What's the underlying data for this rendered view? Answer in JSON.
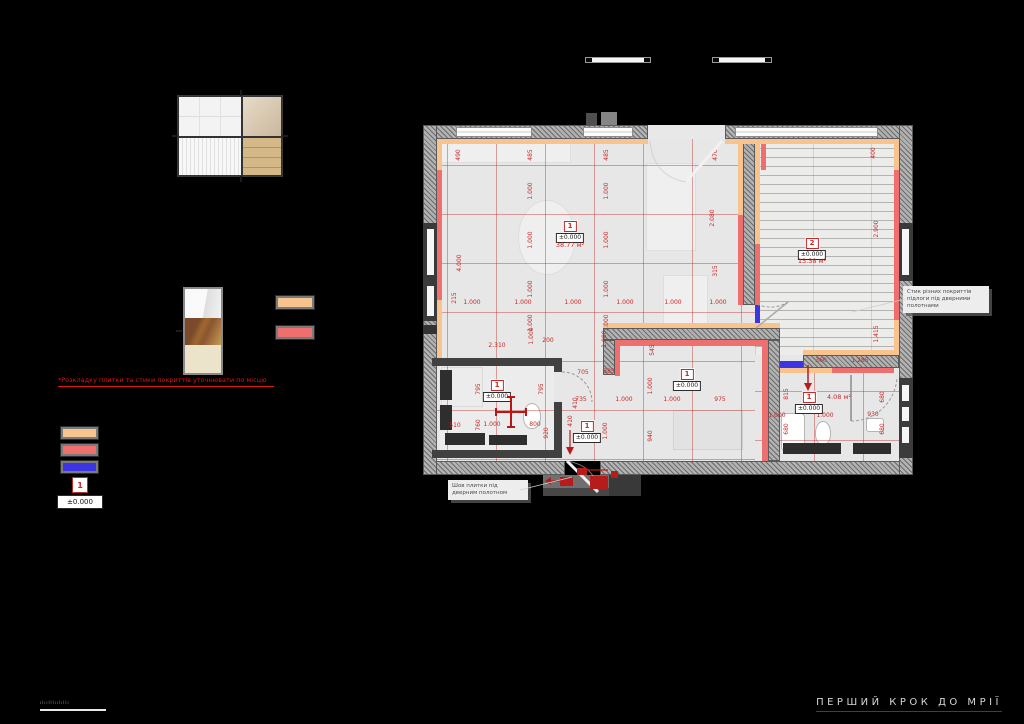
{
  "page": {
    "bg": "#000000"
  },
  "colors": {
    "accent_orange": "#F7C490",
    "accent_red": "#EF6E6E",
    "accent_blue": "#3D35E3",
    "dim_red": "#C62828"
  },
  "legend": {
    "note": "*Розкладку плитки та стики покриттів уточнювати по місцю",
    "room_index_label": "1"
  },
  "callouts": {
    "junction": "Стик різних покриттів\nпідлоги під дверними\nполотнами",
    "tile_seam": "Шов плитки під\nдверним полотном"
  },
  "plan": {
    "elevation": "±0.000",
    "rooms": [
      {
        "num": "1",
        "x": 147,
        "y": 96
      },
      {
        "num": "2",
        "x": 389,
        "y": 113
      },
      {
        "num": "1",
        "x": 74,
        "y": 255
      },
      {
        "num": "1",
        "x": 264,
        "y": 244
      },
      {
        "num": "1",
        "x": 164,
        "y": 296
      },
      {
        "num": "1",
        "x": 386,
        "y": 267
      }
    ],
    "area_labels": [
      {
        "t": "38.77 м²",
        "x": 147,
        "y": 120
      },
      {
        "t": "13.38 м²",
        "x": 389,
        "y": 136
      },
      {
        "t": "4.08 м²",
        "x": 416,
        "y": 272
      }
    ],
    "dim_labels": [
      {
        "t": "490",
        "x": 36,
        "y": 30,
        "v": 1
      },
      {
        "t": "485",
        "x": 108,
        "y": 30,
        "v": 1
      },
      {
        "t": "485",
        "x": 184,
        "y": 30,
        "v": 1
      },
      {
        "t": "470",
        "x": 293,
        "y": 30,
        "v": 1
      },
      {
        "t": "400",
        "x": 451,
        "y": 28,
        "v": 1
      },
      {
        "t": "1.000",
        "x": 108,
        "y": 66,
        "v": 1
      },
      {
        "t": "1.000",
        "x": 108,
        "y": 115,
        "v": 1
      },
      {
        "t": "1.000",
        "x": 108,
        "y": 164,
        "v": 1
      },
      {
        "t": "1.000",
        "x": 108,
        "y": 198,
        "v": 1
      },
      {
        "t": "1.000",
        "x": 184,
        "y": 66,
        "v": 1
      },
      {
        "t": "1.000",
        "x": 184,
        "y": 115,
        "v": 1
      },
      {
        "t": "1.000",
        "x": 184,
        "y": 164,
        "v": 1
      },
      {
        "t": "1.000",
        "x": 184,
        "y": 198,
        "v": 1
      },
      {
        "t": "2.080",
        "x": 290,
        "y": 93,
        "v": 1
      },
      {
        "t": "315",
        "x": 293,
        "y": 146,
        "v": 1
      },
      {
        "t": "2.900",
        "x": 454,
        "y": 104,
        "v": 1
      },
      {
        "t": "4.000",
        "x": 37,
        "y": 138,
        "v": 1
      },
      {
        "t": "215",
        "x": 32,
        "y": 173,
        "v": 1
      },
      {
        "t": "1.415",
        "x": 454,
        "y": 209,
        "v": 1
      },
      {
        "t": "545",
        "x": 230,
        "y": 225,
        "v": 1
      },
      {
        "t": "1.000",
        "x": 228,
        "y": 261,
        "v": 1
      },
      {
        "t": "940",
        "x": 228,
        "y": 311,
        "v": 1
      },
      {
        "t": "1.000",
        "x": 183,
        "y": 306,
        "v": 1
      },
      {
        "t": "1.000",
        "x": 109,
        "y": 211,
        "v": 1
      },
      {
        "t": "1.000",
        "x": 182,
        "y": 214,
        "v": 1
      },
      {
        "t": "795",
        "x": 56,
        "y": 264,
        "v": 1
      },
      {
        "t": "795",
        "x": 119,
        "y": 264,
        "v": 1
      },
      {
        "t": "760",
        "x": 56,
        "y": 300,
        "v": 1
      },
      {
        "t": "920",
        "x": 124,
        "y": 308,
        "v": 1
      },
      {
        "t": "410",
        "x": 153,
        "y": 278,
        "v": 1
      },
      {
        "t": "410",
        "x": 148,
        "y": 296,
        "v": 1
      },
      {
        "t": "815",
        "x": 364,
        "y": 269,
        "v": 1
      },
      {
        "t": "680",
        "x": 460,
        "y": 272,
        "v": 1
      },
      {
        "t": "680",
        "x": 364,
        "y": 304,
        "v": 1
      },
      {
        "t": "680",
        "x": 460,
        "y": 304,
        "v": 1
      },
      {
        "t": "1.000",
        "x": 49,
        "y": 178
      },
      {
        "t": "1.000",
        "x": 100,
        "y": 178
      },
      {
        "t": "1.000",
        "x": 150,
        "y": 178
      },
      {
        "t": "1.000",
        "x": 202,
        "y": 178
      },
      {
        "t": "1.000",
        "x": 250,
        "y": 178
      },
      {
        "t": "1.000",
        "x": 295,
        "y": 178
      },
      {
        "t": "2.310",
        "x": 74,
        "y": 221
      },
      {
        "t": "200",
        "x": 125,
        "y": 216
      },
      {
        "t": "705",
        "x": 160,
        "y": 248
      },
      {
        "t": "385",
        "x": 186,
        "y": 247
      },
      {
        "t": "735",
        "x": 158,
        "y": 275
      },
      {
        "t": "1.000",
        "x": 201,
        "y": 275
      },
      {
        "t": "1.000",
        "x": 249,
        "y": 275
      },
      {
        "t": "975",
        "x": 297,
        "y": 275
      },
      {
        "t": "510",
        "x": 32,
        "y": 301
      },
      {
        "t": "1.000",
        "x": 69,
        "y": 300
      },
      {
        "t": "800",
        "x": 112,
        "y": 300
      },
      {
        "t": "360",
        "x": 398,
        "y": 236
      },
      {
        "t": "1.285",
        "x": 437,
        "y": 236
      },
      {
        "t": "1.000",
        "x": 354,
        "y": 291
      },
      {
        "t": "1.000",
        "x": 402,
        "y": 291
      },
      {
        "t": "930",
        "x": 450,
        "y": 290
      }
    ]
  },
  "footer": {
    "slogan": "ПЕРШИЙ КРОК ДО МРІЇ",
    "watermark": "ılıılllıılıllı"
  }
}
